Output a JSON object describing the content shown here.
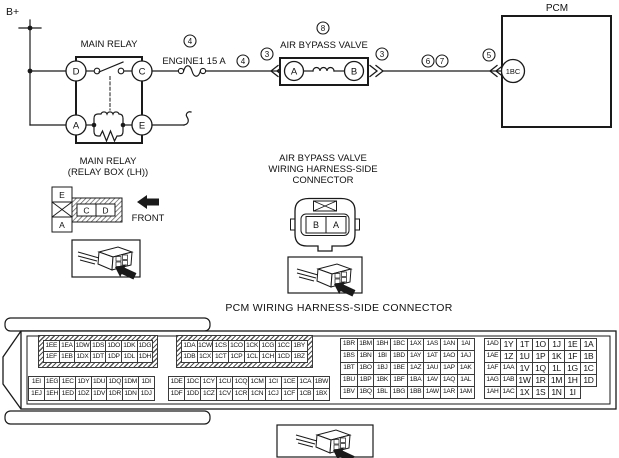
{
  "wiring": {
    "battery": "B+",
    "relay_title": "MAIN RELAY",
    "pin_d": "D",
    "pin_c": "C",
    "pin_a": "A",
    "pin_e": "E",
    "fuse_label": "ENGINE1 15 A",
    "abv_title": "AIR BYPASS VALVE",
    "abv_pin_a": "A",
    "abv_pin_b": "B",
    "pcm_label": "PCM",
    "pcm_pin": "1BC",
    "callouts": {
      "fuse": "4",
      "wire_a": "4",
      "conn_left": "3",
      "abv": "8",
      "conn_right": "3",
      "six": "6",
      "seven": "7",
      "five": "5"
    }
  },
  "relay_detail": {
    "title1": "MAIN RELAY",
    "title2": "(RELAY BOX (LH))",
    "front": "FRONT",
    "pin_e": "E",
    "pin_a": "A",
    "pin_c": "C",
    "pin_d": "D"
  },
  "abv_detail": {
    "title1": "AIR BYPASS VALVE",
    "title2": "WIRING HARNESS-SIDE",
    "title3": "CONNECTOR",
    "pin_b": "B",
    "pin_a": "A"
  },
  "pcm_connector": {
    "title": "PCM WIRING HARNESS-SIDE CONNECTOR",
    "blocks": {
      "upper_left": {
        "rows": [
          [
            "1EE",
            "1EA",
            "1DW",
            "1DS",
            "1DO",
            "1DK",
            "1DG"
          ],
          [
            "1EF",
            "1EB",
            "1DX",
            "1DT",
            "1DP",
            "1DL",
            "1DH"
          ]
        ]
      },
      "upper_right": {
        "rows": [
          [
            "1DA",
            "1CW",
            "1CS",
            "1CO",
            "1CK",
            "1CG",
            "1CC",
            "1BY"
          ],
          [
            "1DB",
            "1CX",
            "1CT",
            "1CP",
            "1CL",
            "1CH",
            "1CD",
            "1BZ"
          ]
        ]
      },
      "lower_left": {
        "rows": [
          [
            "1EI",
            "1EG",
            "1EC",
            "1DY",
            "1DU",
            "1DQ",
            "1DM",
            "1DI"
          ],
          [
            "1EJ",
            "1EH",
            "1ED",
            "1DZ",
            "1DV",
            "1DR",
            "1DN",
            "1DJ"
          ]
        ]
      },
      "lower_right": {
        "rows": [
          [
            "1DE",
            "1DC",
            "1CY",
            "1CU",
            "1CQ",
            "1CM",
            "1CI",
            "1CE",
            "1CA",
            "1BW"
          ],
          [
            "1DF",
            "1DD",
            "1CZ",
            "1CV",
            "1CR",
            "1CN",
            "1CJ",
            "1CF",
            "1CB",
            "1BX"
          ]
        ]
      },
      "right_inner": {
        "rows": [
          [
            "1BR",
            "1BM",
            "1BH",
            "1BC",
            "1AX",
            "1AS",
            "1AN",
            "1AI"
          ],
          [
            "1BS",
            "1BN",
            "1BI",
            "1BD",
            "1AY",
            "1AT",
            "1AO",
            "1AJ"
          ],
          [
            "1BT",
            "1BO",
            "1BJ",
            "1BE",
            "1AZ",
            "1AU",
            "1AP",
            "1AK"
          ],
          [
            "1BU",
            "1BP",
            "1BK",
            "1BF",
            "1BA",
            "1AV",
            "1AQ",
            "1AL"
          ],
          [
            "1BV",
            "1BQ",
            "1BL",
            "1BG",
            "1BB",
            "1AW",
            "1AR",
            "1AM"
          ]
        ]
      },
      "right_outer": {
        "rows": [
          [
            "1AD",
            "1Y",
            "1T",
            "1O",
            "1J",
            "1E",
            "1A"
          ],
          [
            "1AE",
            "1Z",
            "1U",
            "1P",
            "1K",
            "1F",
            "1B"
          ],
          [
            "1AF",
            "1AA",
            "1V",
            "1Q",
            "1L",
            "1G",
            "1C"
          ],
          [
            "1AG",
            "1AB",
            "1W",
            "1R",
            "1M",
            "1H",
            "1D"
          ],
          [
            "1AH",
            "1AC",
            "1X",
            "1S",
            "1N",
            "1I"
          ]
        ]
      }
    }
  },
  "colors": {
    "ink": "#1a1a1a",
    "background": "#ffffff"
  }
}
